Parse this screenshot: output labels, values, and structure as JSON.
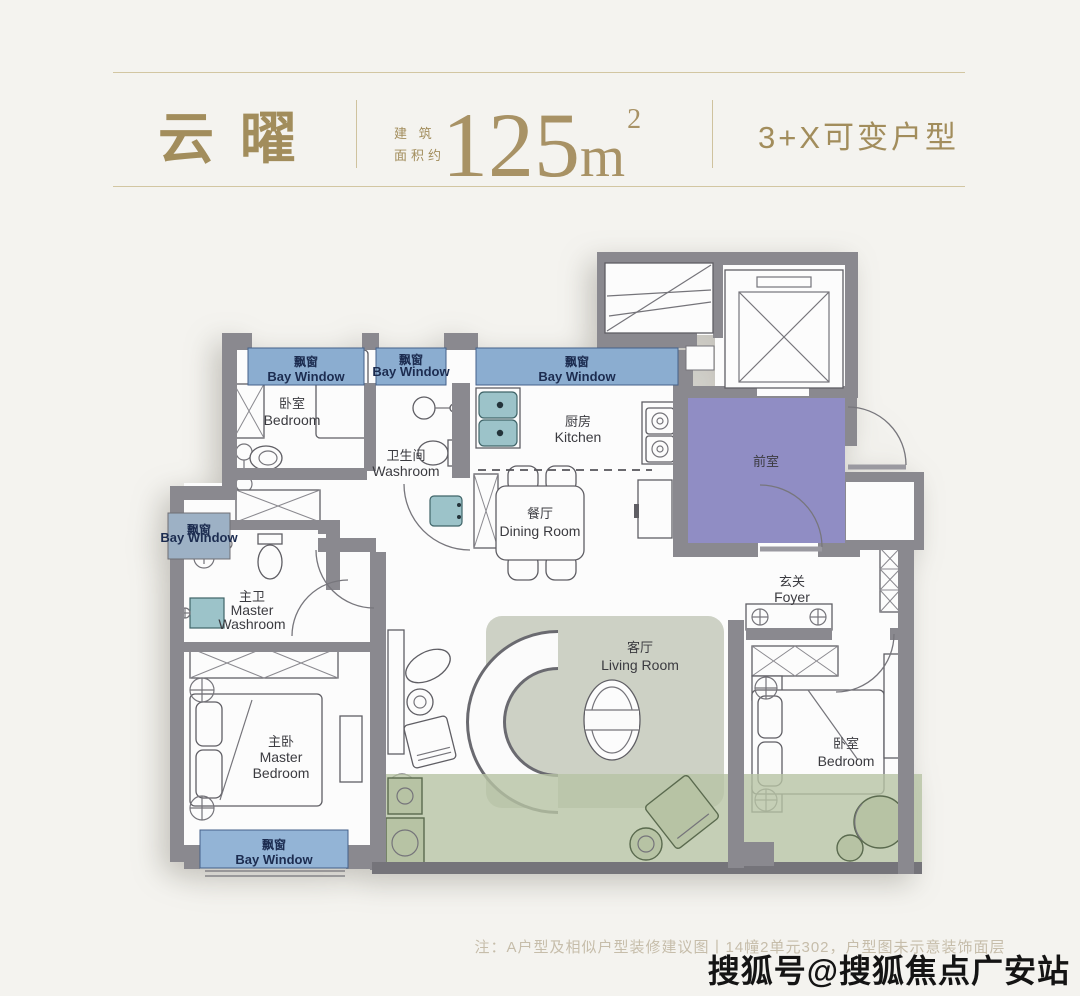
{
  "header": {
    "title": "云曜",
    "area_label_line1": "建 筑",
    "area_label_line2": "面积约",
    "area_value": "125",
    "area_unit": "m",
    "area_exponent": "2",
    "variant": "3+X可变户型"
  },
  "rooms": {
    "bedroom_top": {
      "zh": "卧室",
      "en": "Bedroom"
    },
    "washroom": {
      "zh": "卫生间",
      "en": "Washroom"
    },
    "kitchen": {
      "zh": "厨房",
      "en": "Kitchen"
    },
    "dining": {
      "zh": "餐厅",
      "en": "Dining Room"
    },
    "front_room": {
      "zh": "前室"
    },
    "foyer": {
      "zh": "玄关",
      "en": "Foyer"
    },
    "master_washroom": {
      "zh": "主卫",
      "en1": "Master",
      "en2": "Washroom"
    },
    "master_bedroom": {
      "zh": "主卧",
      "en1": "Master",
      "en2": "Bedroom"
    },
    "living_room": {
      "zh": "客厅",
      "en": "Living Room"
    },
    "bedroom_right": {
      "zh": "卧室",
      "en": "Bedroom"
    }
  },
  "bay_window": {
    "zh": "飘窗",
    "en": "Bay Window"
  },
  "footer": {
    "note": "注：A户型及相似户型装修建议图丨14幢2单元302，户型图未示意装饰面层",
    "watermark": "搜狐号@搜狐焦点广安站"
  },
  "colors": {
    "accent_gold": "#a28d5c",
    "bay_window_blue": "#8badd0",
    "front_room_purple": "#908dc4",
    "flex_zone_green": "#b7c3a4",
    "wall_gray": "#8a898f"
  }
}
